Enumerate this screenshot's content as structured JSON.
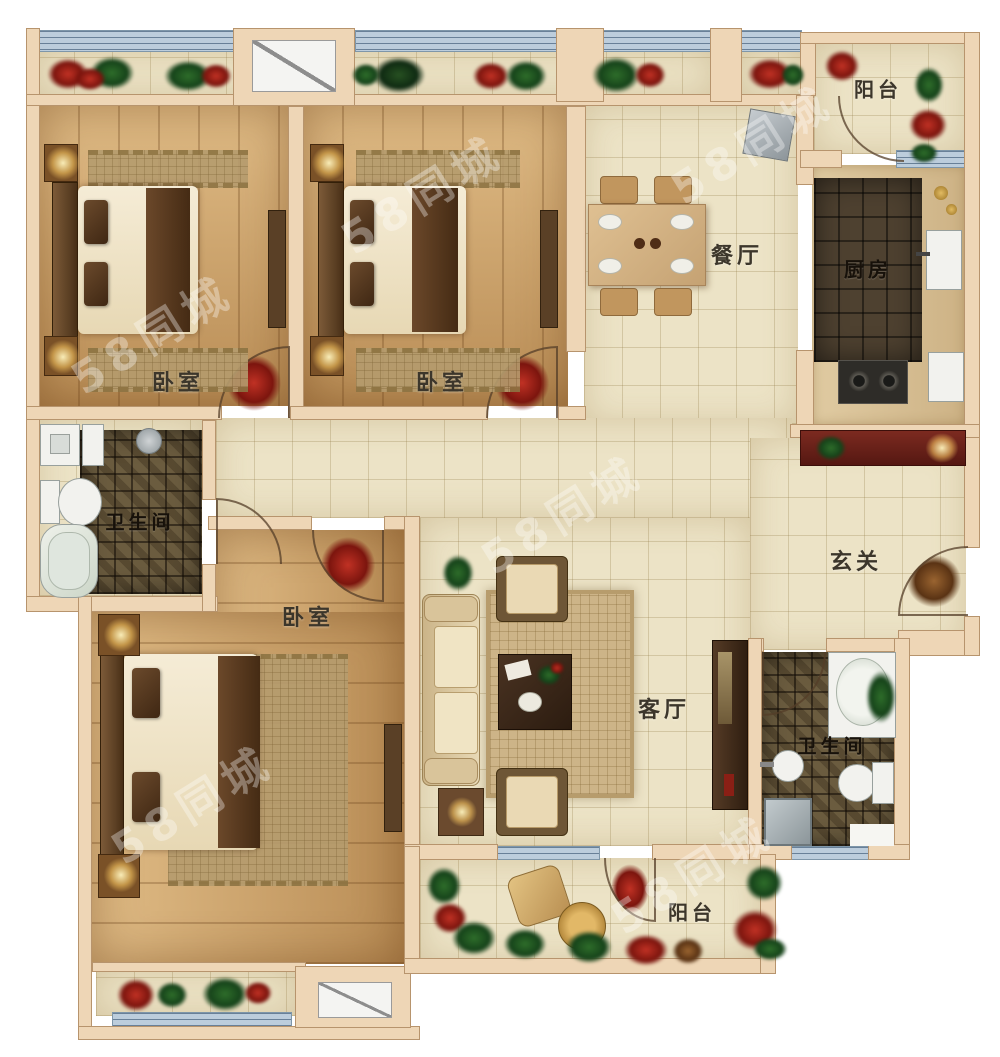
{
  "floor_plan": {
    "watermark": "58同城",
    "colors": {
      "wall": "#eed6b6",
      "floor_tile": "#ece3c6",
      "wood_floor": "#d2a86f",
      "dark_tile": "#4e4130",
      "window": "#bccddc",
      "console_red": "#6a241c",
      "plant_green": "#2e6d2a",
      "flower_red": "#c03124",
      "lamp_glow": "#ffdf9e"
    },
    "rooms": [
      {
        "id": "balcony-top",
        "label": "阳台"
      },
      {
        "id": "kitchen",
        "label": "厨房"
      },
      {
        "id": "dining",
        "label": "餐厅"
      },
      {
        "id": "bedroom-1",
        "label": "卧室"
      },
      {
        "id": "bedroom-2",
        "label": "卧室"
      },
      {
        "id": "bathroom-1",
        "label": "卫生间"
      },
      {
        "id": "entry",
        "label": "玄关"
      },
      {
        "id": "bedroom-3",
        "label": "卧室"
      },
      {
        "id": "living",
        "label": "客厅"
      },
      {
        "id": "bathroom-2",
        "label": "卫生间"
      },
      {
        "id": "balcony-bottom",
        "label": "阳台"
      }
    ]
  }
}
